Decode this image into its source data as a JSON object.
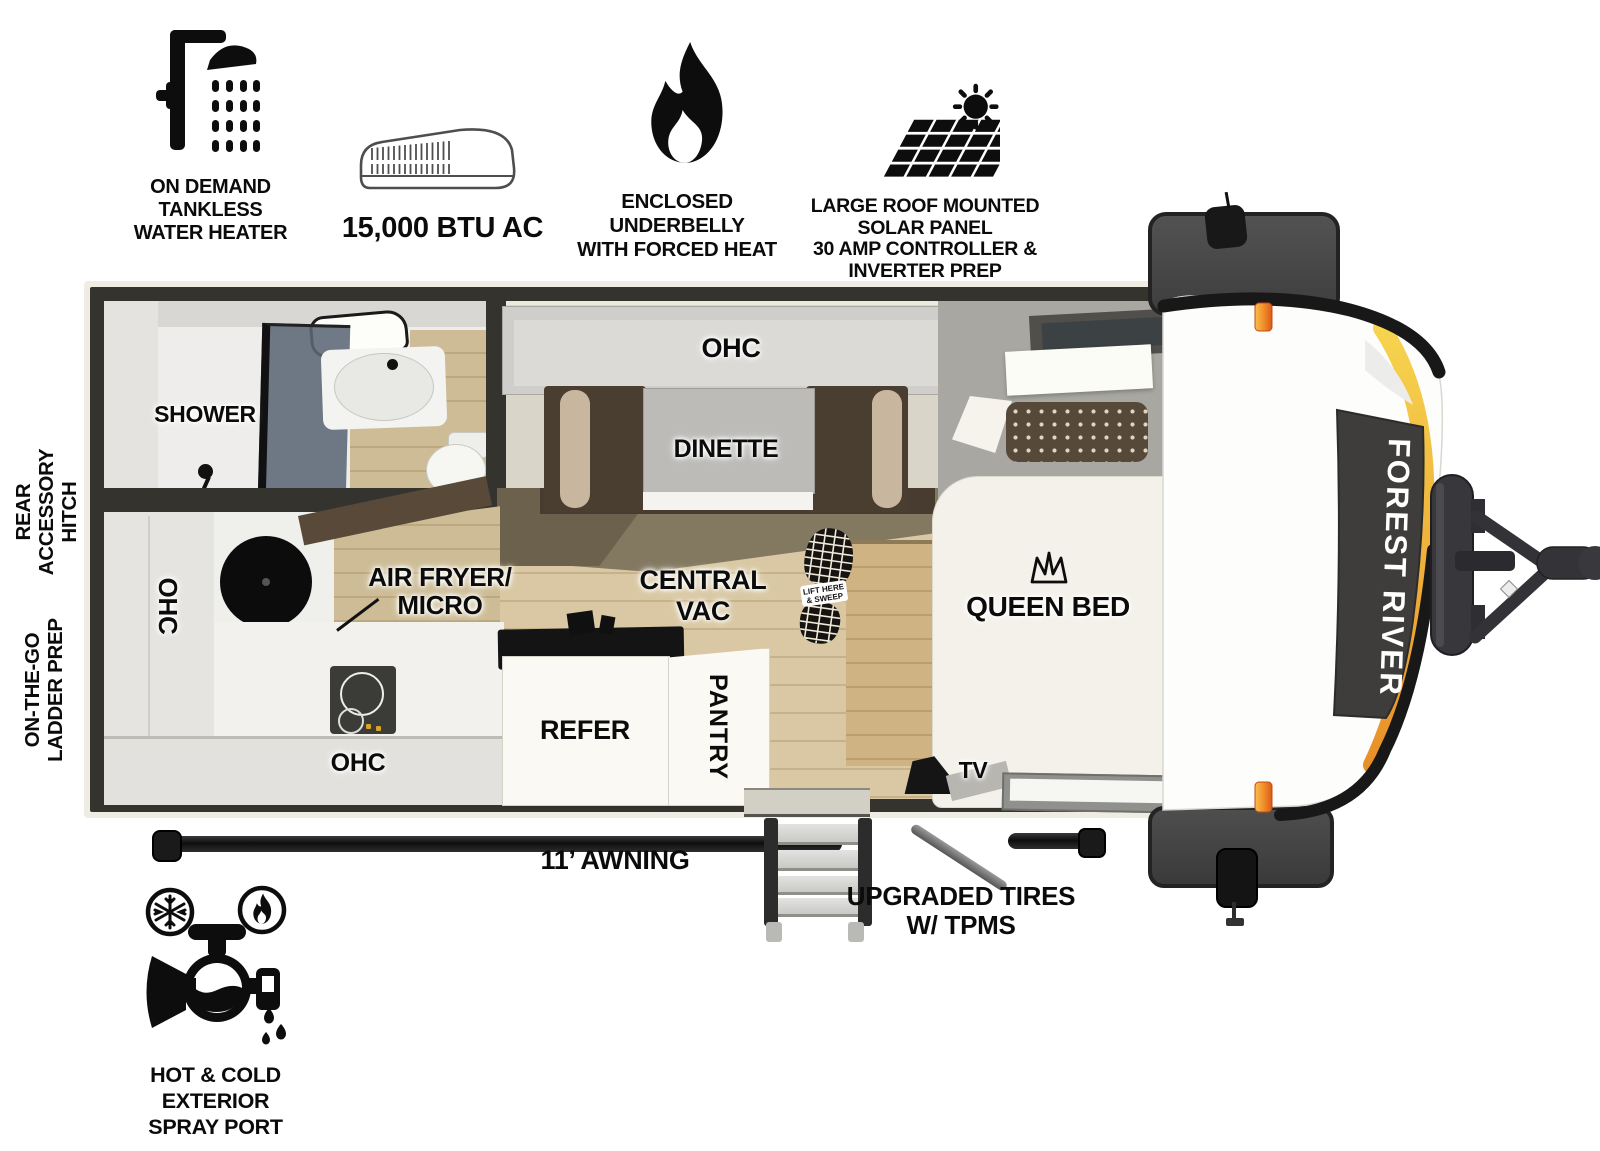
{
  "features": {
    "water_heater": {
      "line1": "ON DEMAND",
      "line2": "TANKLESS",
      "line3": "WATER HEATER"
    },
    "ac": {
      "label": "15,000 BTU AC"
    },
    "underbelly": {
      "line1": "ENCLOSED UNDERBELLY",
      "line2": "WITH FORCED HEAT"
    },
    "solar": {
      "line1": "LARGE ROOF MOUNTED SOLAR PANEL",
      "line2": "30 AMP CONTROLLER & INVERTER PREP"
    }
  },
  "rooms": {
    "shower": "SHOWER",
    "ohc_dinette": "OHC",
    "dinette": "DINETTE",
    "queen_bed": "QUEEN BED",
    "tv": "TV",
    "ohc_kitchen_left": "OHC",
    "air_fryer_line1": "AIR FRYER/",
    "air_fryer_line2": "MICRO",
    "central_vac_line1": "CENTRAL",
    "central_vac_line2": "VAC",
    "ohc_kitchen_bottom": "OHC",
    "refer": "REFER",
    "pantry": "PANTRY",
    "boot_line1": "LIFT HERE",
    "boot_line2": "& SWEEP"
  },
  "exterior": {
    "rear_hitch_line1": "REAR",
    "rear_hitch_line2": "ACCESSORY",
    "rear_hitch_line3": "HITCH",
    "ladder_line1": "ON-THE-GO",
    "ladder_line2": "LADDER PREP",
    "awning": "11’ AWNING",
    "tires_line1": "UPGRADED TIRES",
    "tires_line2": "W/ TPMS",
    "spray_line1": "HOT & COLD EXTERIOR",
    "spray_line2": "SPRAY PORT",
    "brand": "FOREST RIVER"
  },
  "colors": {
    "wall": "#34332e",
    "floor_wood": "#d9c8a3",
    "olive_floor": "#837860",
    "accent_yellow": "#f6d44e",
    "accent_orange": "#e89028",
    "marker_light": "#f9c04a",
    "cap_panel": "#3e3d3b"
  }
}
